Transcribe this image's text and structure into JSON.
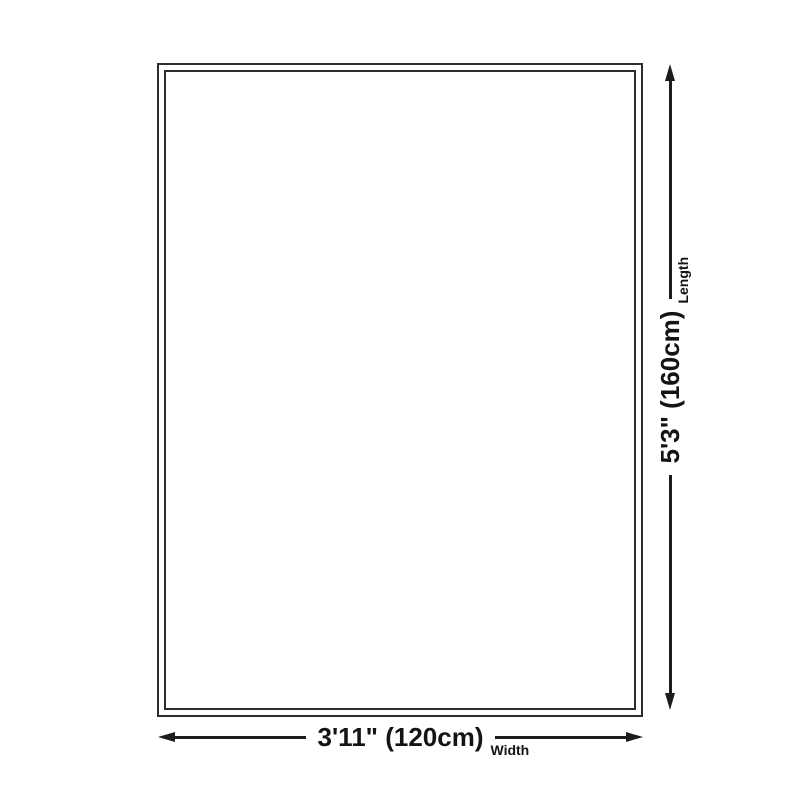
{
  "diagram": {
    "type": "product-dimension-diagram",
    "background_color": "#ffffff",
    "outline_color": "#2d2d2d",
    "annotation_color": "#1c1c1c",
    "length": {
      "value": "5'3\" (160cm)",
      "label": "Length"
    },
    "width": {
      "value": "3'11\" (120cm)",
      "label": "Width"
    }
  }
}
